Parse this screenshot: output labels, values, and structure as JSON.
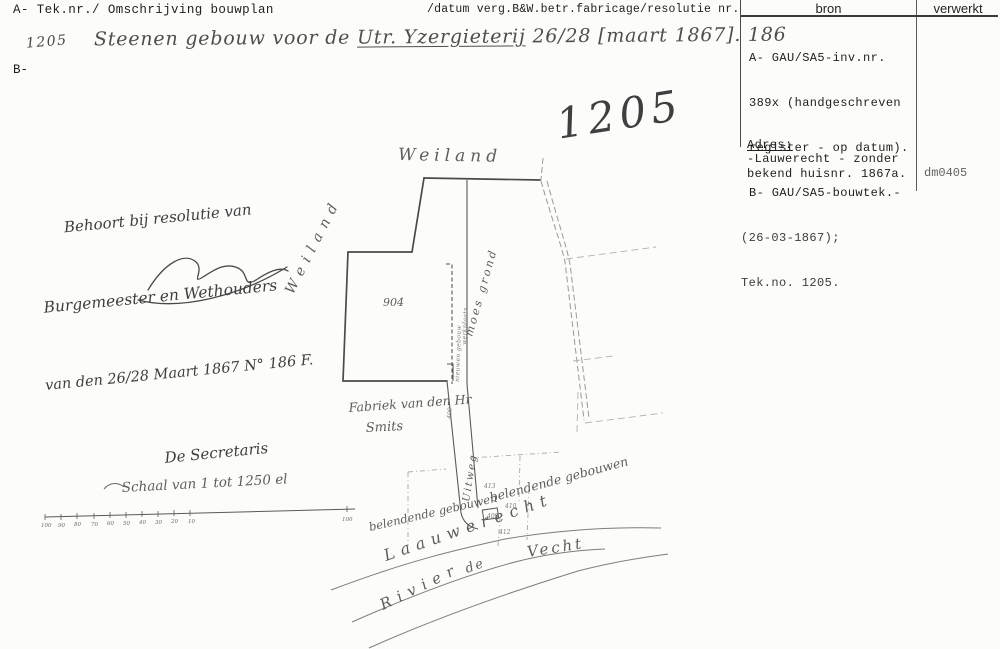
{
  "header": {
    "left": "A- Tek.nr./ Omschrijving bouwplan",
    "right": "/datum verg.B&W.betr.fabricage/resolutie nr."
  },
  "record": {
    "tek_nr_handwritten": "1205",
    "b_prefix": "B-",
    "omschrijving_part1": "Steenen gebouw voor de ",
    "omschrijving_part2_underlined": "Utr. Yzergieterij",
    "omschrijving_part3": " 26/28 [maart 1867]. 186",
    "stamp_number": "1205"
  },
  "bron_panel": {
    "col_bron": "bron",
    "col_verwerkt": "verwerkt",
    "lines": [
      "A- GAU/SA5-inv.nr.",
      "389x (handgeschreven",
      "register - op datum).",
      "B- GAU/SA5-bouwtek.-",
      "(26-03-1867);",
      "Tek.no. 1205."
    ],
    "adres_heading": "Adres:",
    "adres_line1": "-Lauwerecht - zonder",
    "adres_line2": "bekend huisnr. 1867a.",
    "verwerkt_code": "dm0405"
  },
  "resolution_note": {
    "line1": "Behoort bij resolutie van",
    "line2": "Burgemeester en Wethouders",
    "line3": "van den 26/28 Maart 1867 N° 186 F.",
    "line4": "De Secretaris"
  },
  "map": {
    "weiland_top": "Weiland",
    "weiland_left": "Weiland",
    "parcel_number": "904",
    "moes_grond": "moes grond",
    "strip_label1": "nieuwen gebouw",
    "strip_label2": "werkplaats",
    "fabriek_line1": "Fabriek van den Hr",
    "fabriek_line2": "Smits",
    "uitweg": "Uitweg",
    "lane_number": "409",
    "belendende_right": "belendende gebouwen",
    "belendende_left": "belendende gebouwen",
    "street": "Laauwerecht",
    "rivier": "Rivier",
    "de": "de",
    "vecht": "Vecht",
    "plot_413": "413",
    "plot_410": "410",
    "plot_409": "409",
    "plot_412": "412",
    "scale": {
      "caption": "Schaal van 1 tot 1250 el",
      "ticks": [
        "100",
        "90",
        "80",
        "70",
        "60",
        "50",
        "40",
        "30",
        "20",
        "10"
      ],
      "end_label": "100"
    }
  },
  "ink_colors": {
    "typewriter": "#1f1f1f",
    "handwriting": "#4a4a4a",
    "map_outline": "#4a4a4a",
    "faint_pencil": "#9a9a9a"
  }
}
